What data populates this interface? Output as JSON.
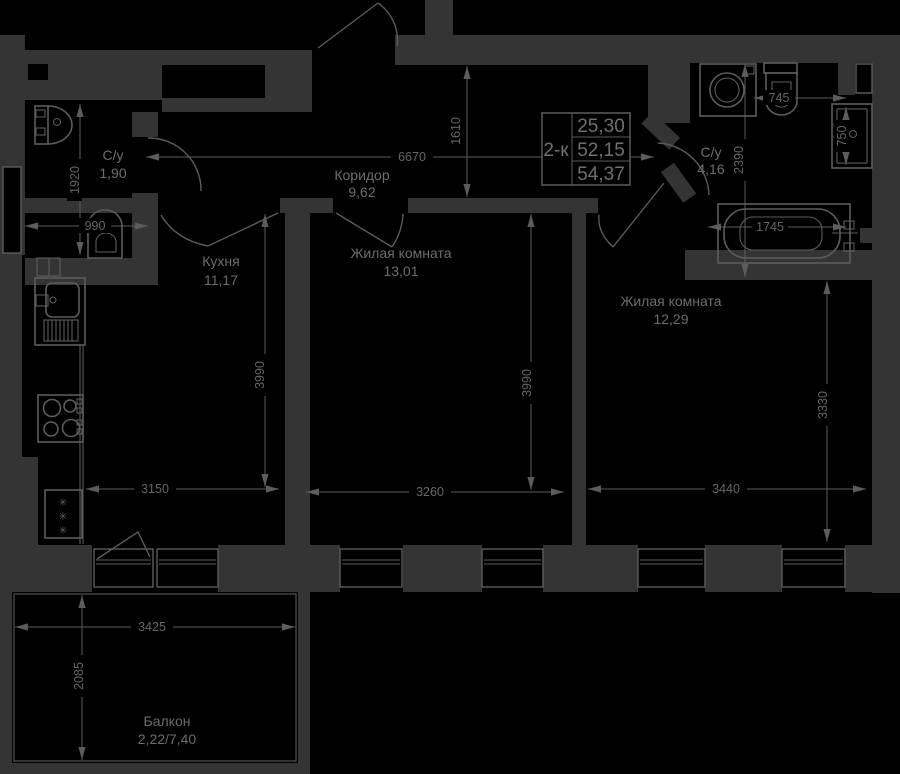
{
  "colors": {
    "background": "#000000",
    "wall": "#343434",
    "line": "#5c5c5c",
    "text": "#6a6a6a"
  },
  "title_block": {
    "type_label": "2-к",
    "row1": "25,30",
    "row2": "52,15",
    "row3": "54,37"
  },
  "rooms": [
    {
      "name": "С/у",
      "area": "1,90"
    },
    {
      "name": "Коридор",
      "area": "9,62"
    },
    {
      "name": "С/у",
      "area": "4,16"
    },
    {
      "name": "Кухня",
      "area": "11,17"
    },
    {
      "name": "Жилая комната",
      "area": "13,01"
    },
    {
      "name": "Жилая комната",
      "area": "12,29"
    },
    {
      "name": "Балкон",
      "area": "2,22/7,40"
    }
  ],
  "dims": {
    "corridor_width": "6670",
    "hall_depth": "1610",
    "bath1_depth": "1920",
    "bath1_toilet_width": "990",
    "bath2_depth": "2390",
    "bath2_toilet_width": "745",
    "bath2_sink_width": "750",
    "bathtub_length": "1745",
    "kitchen_depth": "3990",
    "room1_depth": "3990",
    "room2_depth": "3330",
    "kitchen_width": "3150",
    "room1_width": "3260",
    "room2_width": "3440",
    "balcony_width": "3425",
    "balcony_depth": "2085"
  },
  "icons": {
    "fridge_snowflake": "✳"
  }
}
